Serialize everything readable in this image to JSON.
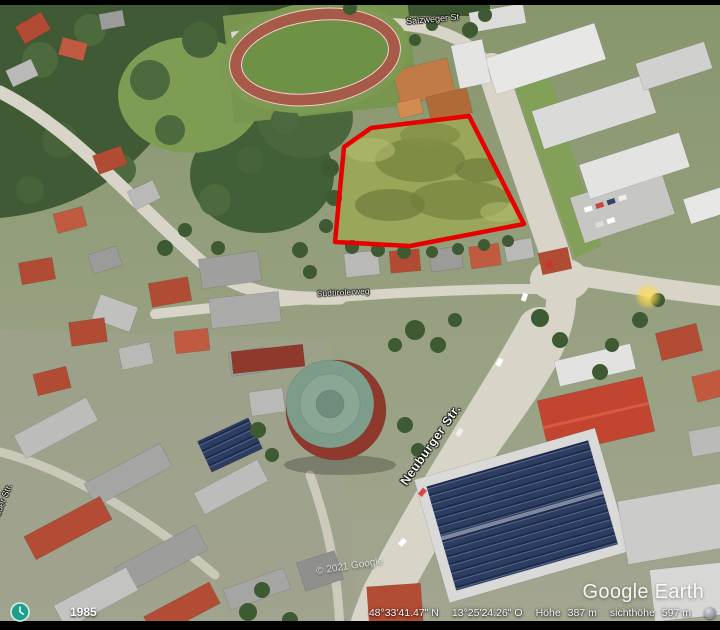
{
  "app": {
    "name": "Google Earth"
  },
  "map": {
    "street_labels": {
      "top": "Salzweger St",
      "mid": "Südtirolerweg",
      "main_road": "Neuburger Str.",
      "left_partial": "auer Str."
    },
    "watermarks": {
      "copyright": "© 2021 Google",
      "logo": "Google Earth"
    },
    "plot_outline_color": "#e80000",
    "imagery_year": "1985"
  },
  "status_bar": {
    "latitude": "48°33'41.47\" N",
    "longitude": "13°25'24.26\" O",
    "elevation_label": "Höhe",
    "elevation_value": "387 m",
    "eye_altitude_label": "sichthöhe",
    "eye_altitude_value": "597 m"
  },
  "controls": {
    "north_label": "N",
    "zoom_in_label": "+",
    "zoom_out_label": "−"
  }
}
